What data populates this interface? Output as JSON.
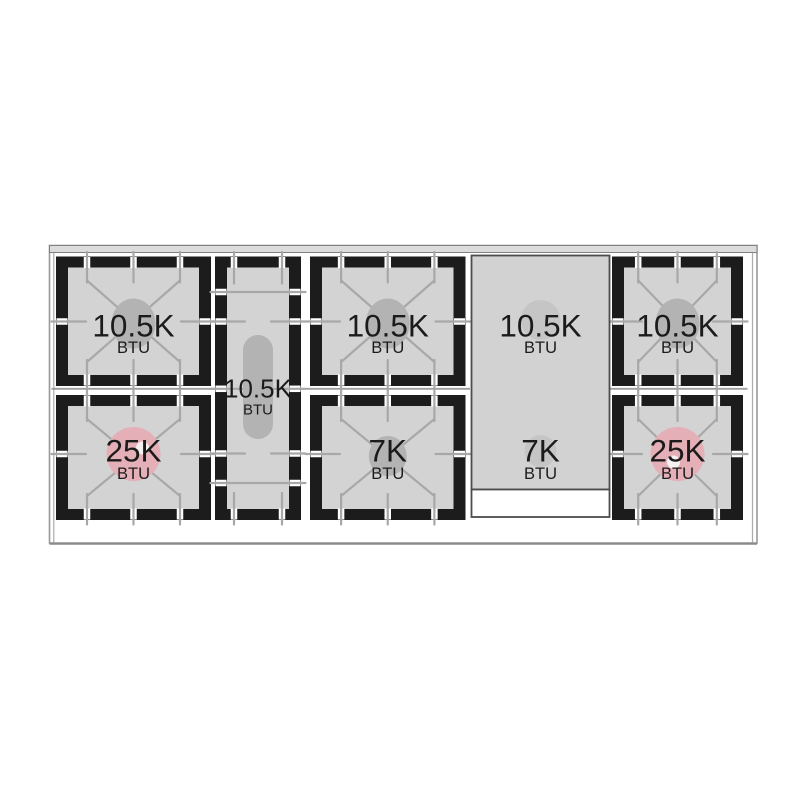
{
  "diagram": {
    "kind": "range-cooktop-top-view",
    "cooktop": {
      "sections": [
        {
          "name": "left-column",
          "burners": [
            {
              "position": "rear",
              "value": "10.5K",
              "unit": "BTU"
            },
            {
              "position": "front",
              "value": "25K",
              "unit": "BTU"
            }
          ]
        },
        {
          "name": "center-left-oval",
          "burners": [
            {
              "position": "center",
              "value": "10.5K",
              "unit": "BTU"
            }
          ]
        },
        {
          "name": "center-column",
          "burners": [
            {
              "position": "rear",
              "value": "10.5K",
              "unit": "BTU"
            },
            {
              "position": "front",
              "value": "7K",
              "unit": "BTU"
            }
          ]
        },
        {
          "name": "griddle",
          "burners": [
            {
              "position": "rear",
              "value": "10.5K",
              "unit": "BTU"
            },
            {
              "position": "front",
              "value": "7K",
              "unit": "BTU"
            }
          ]
        },
        {
          "name": "right-column",
          "burners": [
            {
              "position": "rear",
              "value": "10.5K",
              "unit": "BTU"
            },
            {
              "position": "front",
              "value": "25K",
              "unit": "BTU"
            }
          ]
        }
      ],
      "colors": {
        "grate_frame": "#1c1c1c",
        "burner_surface": "#d3d3d3",
        "grate_line": "#a8a8a8",
        "cap_gray": "#b3b3b3",
        "cap_pink": "#e5afb7",
        "igniter_dot": "#f6f1f1",
        "griddle_surface": "#d2d2d2",
        "griddle_shadow": "#c5c5c5",
        "backguard": "#dcdcdc",
        "outline": "#8f8f8f"
      }
    }
  }
}
